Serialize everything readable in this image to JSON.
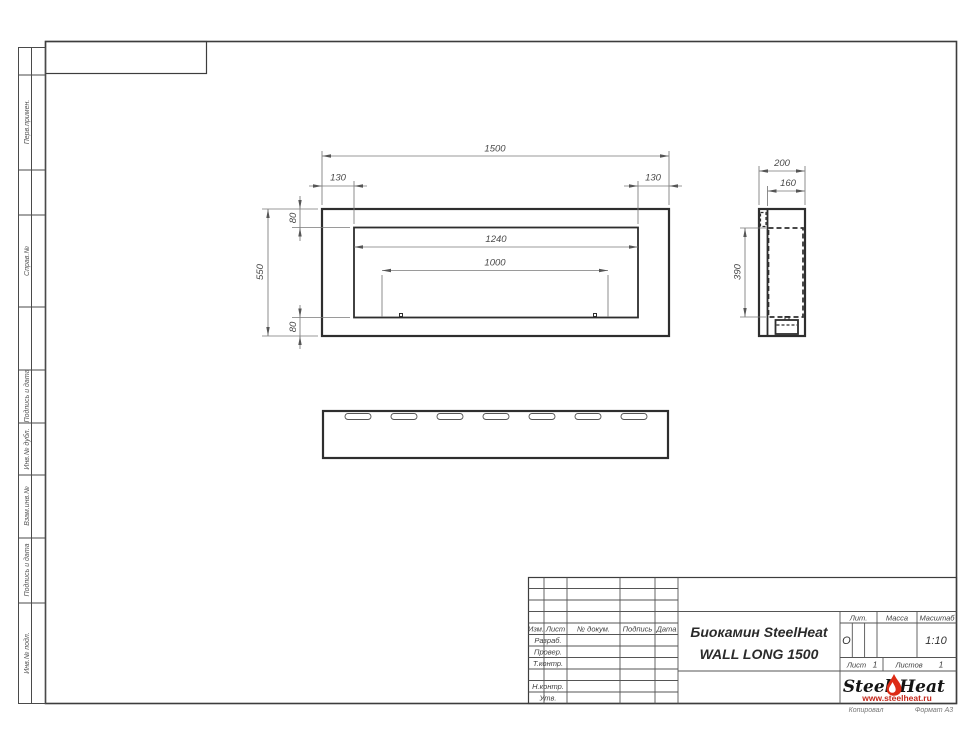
{
  "document": {
    "kind": "engineering-drawing",
    "product": "Биокамин SteelHeat WALL LONG 1500"
  },
  "colors": {
    "outline": "#2e2e2e",
    "dim_line": "#7a7a7a",
    "logo_red": "#c3271b",
    "flame_red": "#dd2b15"
  },
  "sidebar": {
    "labels": [
      "Перв.примен.",
      "Справ.№",
      "Подпись и дата",
      "Инв.№ дубл.",
      "Взам.инв.№",
      "Подпись и дата",
      "Инв.№ подл."
    ]
  },
  "stamp": {
    "cols": [
      "Изм.",
      "Лист",
      "№ докум.",
      "Подпись",
      "Дата"
    ],
    "rows": [
      "Разраб.",
      "Провер.",
      "Т.контр.",
      "Н.контр.",
      "Утв."
    ],
    "title1": "Биокамин SteelHeat",
    "title2": "WALL LONG 1500",
    "lit_label": "Лит.",
    "mass_label": "Масса",
    "scale_label": "Масштаб",
    "lit_value": "О",
    "scale_value": "1:10",
    "sheet_label": "Лист",
    "sheet_value": "1",
    "sheets_label": "Листов",
    "sheets_value": "1",
    "copied": "Копировал",
    "format": "Формат А3"
  },
  "logo": {
    "word1": "Steel",
    "word2": "Heat",
    "url": "www.steelheat.ru",
    "flame_icon": "flame-icon"
  },
  "dims": {
    "front": {
      "total_width": "1500",
      "offset_left": "130",
      "offset_right": "130",
      "offset_top": "80",
      "height": "550",
      "offset_bottom": "80",
      "opening_width": "1240",
      "burner_width": "1000"
    },
    "side": {
      "depth": "200",
      "inner_depth": "160",
      "inner_height": "390"
    }
  }
}
